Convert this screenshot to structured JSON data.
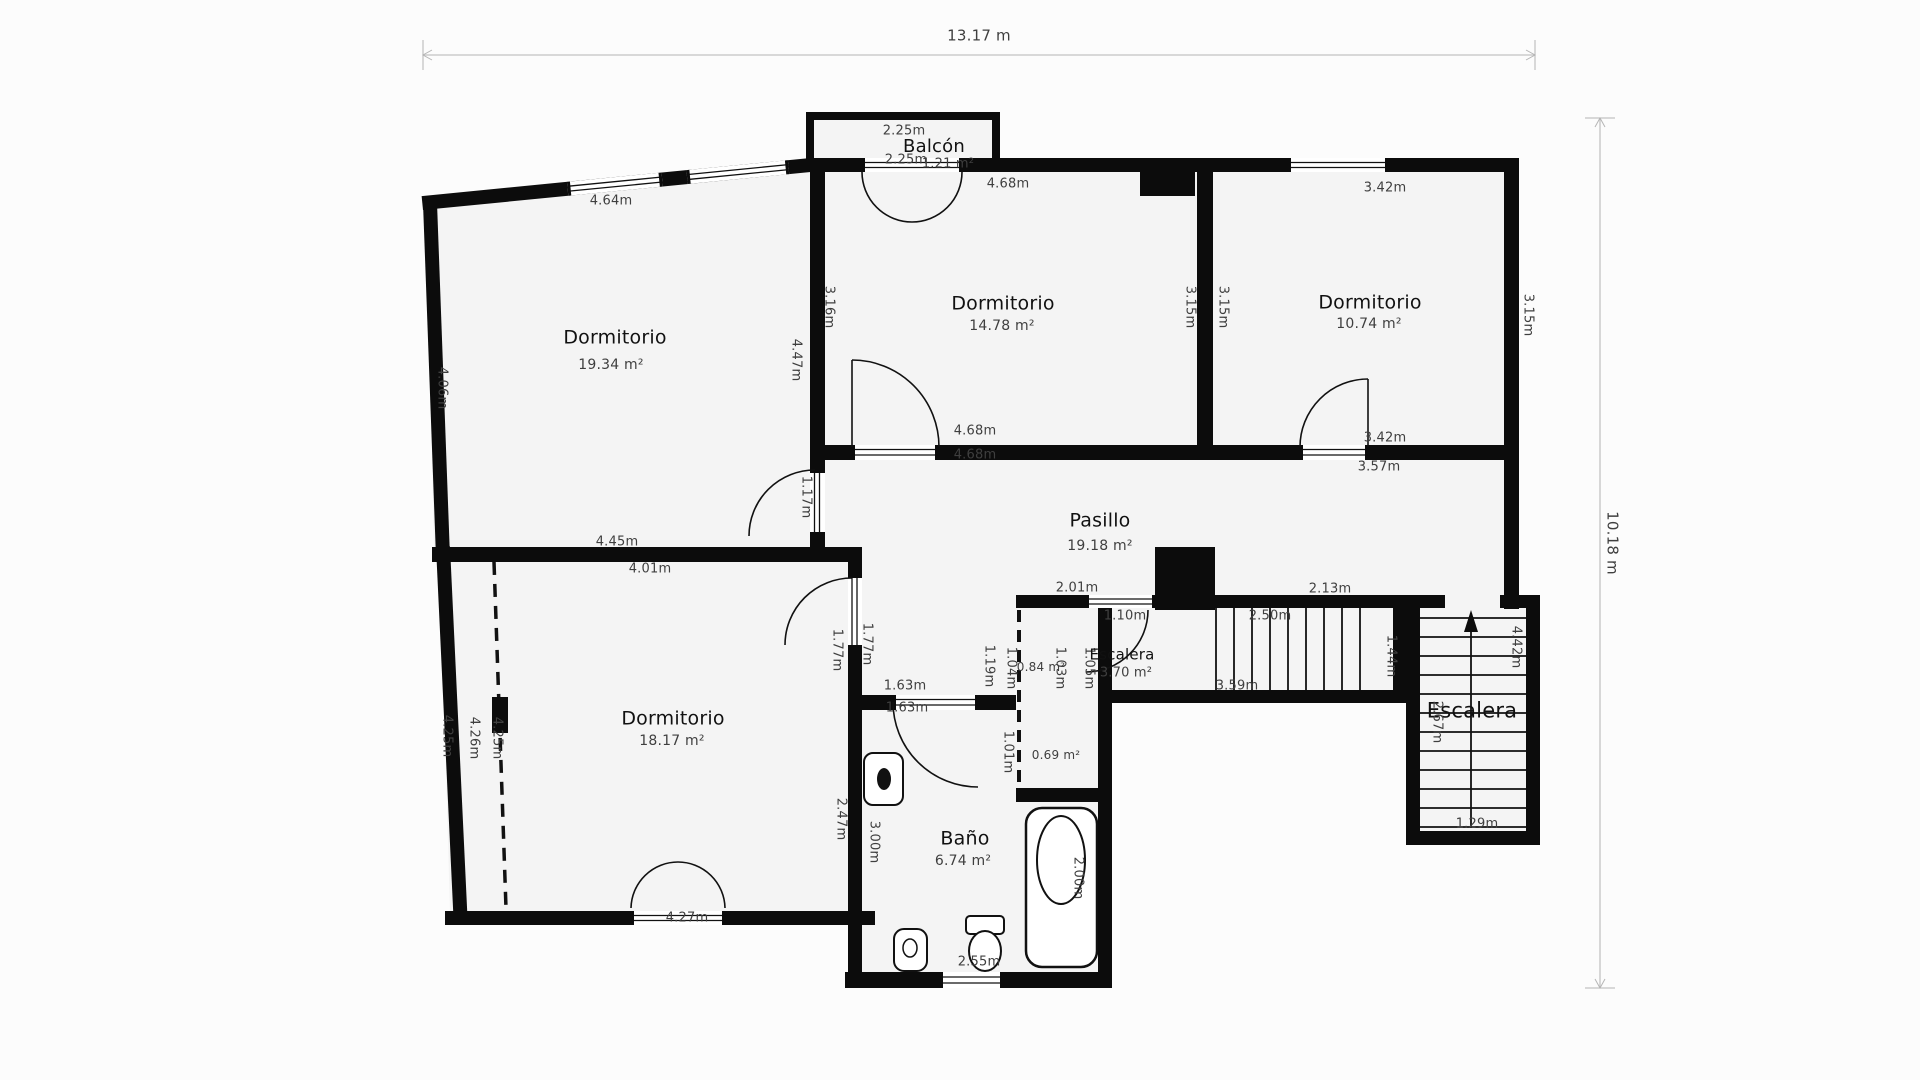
{
  "theme": {
    "background": "#fcfcfc",
    "wall_color": "#0c0c0c",
    "room_fill": "#f4f4f4",
    "dim_text_color": "#3f3f3f",
    "title_text_color": "#111111",
    "dim_line_color": "#c3c3c3"
  },
  "overall_dimensions": {
    "width": "13.17 m",
    "height": "10.18 m"
  },
  "rooms": [
    {
      "name": "Balcón",
      "area": "1.21 m²"
    },
    {
      "name": "Dormitorio",
      "area": "19.34 m²"
    },
    {
      "name": "Dormitorio",
      "area": "14.78 m²"
    },
    {
      "name": "Dormitorio",
      "area": "10.74 m²"
    },
    {
      "name": "Pasillo",
      "area": "19.18 m²"
    },
    {
      "name": "Dormitorio",
      "area": "18.17 m²"
    },
    {
      "name": "Baño",
      "area": "6.74 m²"
    },
    {
      "name": "Escalera",
      "area": "3.70 m²"
    },
    {
      "name": "Escalera",
      "area": ""
    },
    {
      "name": "",
      "area": "0.84 m²"
    },
    {
      "name": "",
      "area": "0.69 m²"
    }
  ],
  "labels": [
    {
      "name": "dim-overall-width",
      "text": "13.17 m",
      "x": 979,
      "y": 36,
      "size": 15
    },
    {
      "name": "dim-overall-height",
      "text": "10.18 m",
      "x": 1612,
      "y": 543,
      "size": 15,
      "rot": 90
    },
    {
      "name": "balcon-width",
      "text": "2.25m",
      "x": 904,
      "y": 131
    },
    {
      "name": "room-balcon-title",
      "text": "Balcón",
      "x": 934,
      "y": 147,
      "size": 18,
      "title": true
    },
    {
      "name": "balcon-width-bottom",
      "text": "2.25m",
      "x": 906,
      "y": 160
    },
    {
      "name": "balcon-area",
      "text": "1.21 m²",
      "x": 948,
      "y": 164
    },
    {
      "name": "dim",
      "text": "4.64m",
      "x": 611,
      "y": 201
    },
    {
      "name": "dim",
      "text": "4.68m",
      "x": 1008,
      "y": 184
    },
    {
      "name": "dim",
      "text": "3.42m",
      "x": 1385,
      "y": 188
    },
    {
      "name": "room-dormitorio1-title",
      "text": "Dormitorio",
      "x": 615,
      "y": 338,
      "size": 19,
      "title": true
    },
    {
      "name": "room-dormitorio1-area",
      "text": "19.34 m²",
      "x": 611,
      "y": 365,
      "size": 14
    },
    {
      "name": "room-dormitorio2-title",
      "text": "Dormitorio",
      "x": 1003,
      "y": 304,
      "size": 19,
      "title": true
    },
    {
      "name": "room-dormitorio2-area",
      "text": "14.78 m²",
      "x": 1002,
      "y": 326,
      "size": 14
    },
    {
      "name": "room-dormitorio3-title",
      "text": "Dormitorio",
      "x": 1370,
      "y": 303,
      "size": 19,
      "title": true
    },
    {
      "name": "room-dormitorio3-area",
      "text": "10.74 m²",
      "x": 1369,
      "y": 324,
      "size": 14
    },
    {
      "name": "dim",
      "text": "4.06m",
      "x": 442,
      "y": 388,
      "rot": 90
    },
    {
      "name": "dim",
      "text": "3.16m",
      "x": 829,
      "y": 307,
      "rot": 90
    },
    {
      "name": "dim",
      "text": "4.47m",
      "x": 796,
      "y": 360,
      "rot": 90
    },
    {
      "name": "dim",
      "text": "3.15m",
      "x": 1190,
      "y": 307,
      "rot": 90
    },
    {
      "name": "dim",
      "text": "3.15m",
      "x": 1223,
      "y": 307,
      "rot": 90
    },
    {
      "name": "dim",
      "text": "3.15m",
      "x": 1528,
      "y": 315,
      "rot": 90
    },
    {
      "name": "dim",
      "text": "4.68m",
      "x": 975,
      "y": 431
    },
    {
      "name": "dim",
      "text": "4.68m",
      "x": 975,
      "y": 455
    },
    {
      "name": "dim",
      "text": "3.42m",
      "x": 1385,
      "y": 438
    },
    {
      "name": "dim",
      "text": "3.57m",
      "x": 1379,
      "y": 467
    },
    {
      "name": "room-pasillo-title",
      "text": "Pasillo",
      "x": 1100,
      "y": 521,
      "size": 19,
      "title": true
    },
    {
      "name": "room-pasillo-area",
      "text": "19.18 m²",
      "x": 1100,
      "y": 546,
      "size": 14
    },
    {
      "name": "dim",
      "text": "1.17m",
      "x": 806,
      "y": 497,
      "rot": 90
    },
    {
      "name": "dim",
      "text": "4.45m",
      "x": 617,
      "y": 542
    },
    {
      "name": "dim",
      "text": "4.01m",
      "x": 650,
      "y": 569
    },
    {
      "name": "dim",
      "text": "1.77m",
      "x": 837,
      "y": 650,
      "rot": 90
    },
    {
      "name": "dim",
      "text": "1.77m",
      "x": 867,
      "y": 644,
      "rot": 90
    },
    {
      "name": "dim",
      "text": "1.63m",
      "x": 905,
      "y": 686
    },
    {
      "name": "dim",
      "text": "1.63m",
      "x": 907,
      "y": 708
    },
    {
      "name": "dim",
      "text": "4.25m",
      "x": 447,
      "y": 736,
      "rot": 90
    },
    {
      "name": "dim",
      "text": "4.26m",
      "x": 474,
      "y": 738,
      "rot": 90
    },
    {
      "name": "dim",
      "text": "4.25m",
      "x": 497,
      "y": 738,
      "rot": 90
    },
    {
      "name": "room-dormitorio4-title",
      "text": "Dormitorio",
      "x": 673,
      "y": 719,
      "size": 19,
      "title": true
    },
    {
      "name": "room-dormitorio4-area",
      "text": "18.17 m²",
      "x": 672,
      "y": 741,
      "size": 14
    },
    {
      "name": "dim",
      "text": "4.27m",
      "x": 687,
      "y": 918
    },
    {
      "name": "dim",
      "text": "2.47m",
      "x": 841,
      "y": 819,
      "rot": 90
    },
    {
      "name": "dim",
      "text": "3.00m",
      "x": 874,
      "y": 842,
      "rot": 90
    },
    {
      "name": "room-bano-title",
      "text": "Baño",
      "x": 965,
      "y": 839,
      "size": 19,
      "title": true
    },
    {
      "name": "room-bano-area",
      "text": "6.74 m²",
      "x": 963,
      "y": 861,
      "size": 14
    },
    {
      "name": "dim",
      "text": "2.00m",
      "x": 1078,
      "y": 878,
      "rot": 90
    },
    {
      "name": "dim",
      "text": "2.55m",
      "x": 979,
      "y": 962
    },
    {
      "name": "dim",
      "text": "2.01m",
      "x": 1077,
      "y": 588
    },
    {
      "name": "dim",
      "text": "1.10m",
      "x": 1125,
      "y": 616
    },
    {
      "name": "dim",
      "text": "1.19m",
      "x": 989,
      "y": 666,
      "rot": 90
    },
    {
      "name": "dim",
      "text": "1.04m",
      "x": 1011,
      "y": 668,
      "rot": 90
    },
    {
      "name": "closet-area",
      "text": "0.84 m²",
      "x": 1041,
      "y": 667,
      "size": 12
    },
    {
      "name": "dim",
      "text": "1.03m",
      "x": 1060,
      "y": 668,
      "rot": 90
    },
    {
      "name": "dim",
      "text": "1.05m",
      "x": 1089,
      "y": 668,
      "rot": 90
    },
    {
      "name": "dim",
      "text": "1.01m",
      "x": 1008,
      "y": 752,
      "rot": 90
    },
    {
      "name": "small-space-area",
      "text": "0.69 m²",
      "x": 1056,
      "y": 755,
      "size": 12
    },
    {
      "name": "room-escalera1-title",
      "text": "Escalera",
      "x": 1122,
      "y": 655,
      "size": 15,
      "title": true
    },
    {
      "name": "room-escalera1-area",
      "text": "3.70 m²",
      "x": 1126,
      "y": 673
    },
    {
      "name": "dim",
      "text": "2.50m",
      "x": 1270,
      "y": 616
    },
    {
      "name": "dim",
      "text": "2.13m",
      "x": 1330,
      "y": 589
    },
    {
      "name": "dim",
      "text": "3.59m",
      "x": 1237,
      "y": 686
    },
    {
      "name": "dim",
      "text": "1.44m",
      "x": 1391,
      "y": 656,
      "rot": 90
    },
    {
      "name": "room-escalera2-title",
      "text": "Escalera",
      "x": 1472,
      "y": 711,
      "size": 21,
      "title": true
    },
    {
      "name": "dim",
      "text": "2.67m",
      "x": 1437,
      "y": 722,
      "rot": 90
    },
    {
      "name": "dim",
      "text": "4.42m",
      "x": 1516,
      "y": 647,
      "rot": 90
    },
    {
      "name": "dim",
      "text": "1.29m",
      "x": 1477,
      "y": 824
    }
  ]
}
